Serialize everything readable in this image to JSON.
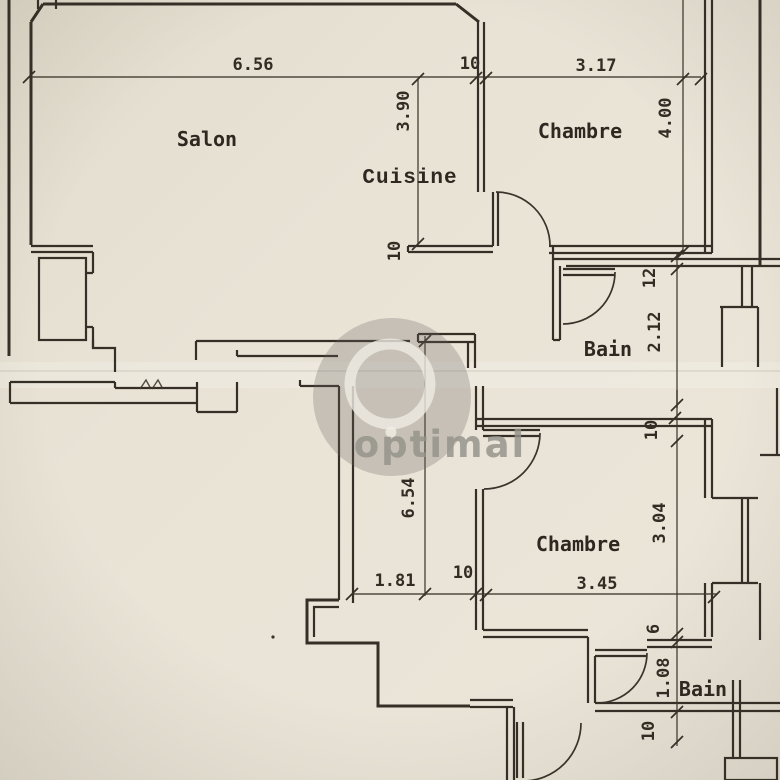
{
  "watermark": {
    "brand": "optimal"
  },
  "rooms": {
    "salon": "Salon",
    "cuisine": "Cuisine",
    "chambre_top": "Chambre",
    "bain_top": "Bain",
    "chambre_bottom": "Chambre",
    "bain_bottom": "Bain"
  },
  "dimensions": {
    "salon_width": "6.56",
    "wall_top": "10",
    "chambre_top_width": "3.17",
    "cuisine_depth": "3.90",
    "chambre_top_depth": "4.00",
    "wall_mid": "12",
    "bain_top_depth": "2.12",
    "hall_wall": "10",
    "corridor_depth": "6.54",
    "corridor_width": "1.81",
    "wall_lower": "10",
    "chambre_bottom_width": "3.45",
    "wall_chambre_bottom": "10",
    "chambre_bottom_depth": "3.04",
    "wall_bain_bottom": "6",
    "bain_bottom_depth": "1.08",
    "wall_bottom": "10"
  },
  "colors": {
    "paper": "#e9e3d6",
    "ink": "#362f27",
    "watermark": "#918e87"
  }
}
